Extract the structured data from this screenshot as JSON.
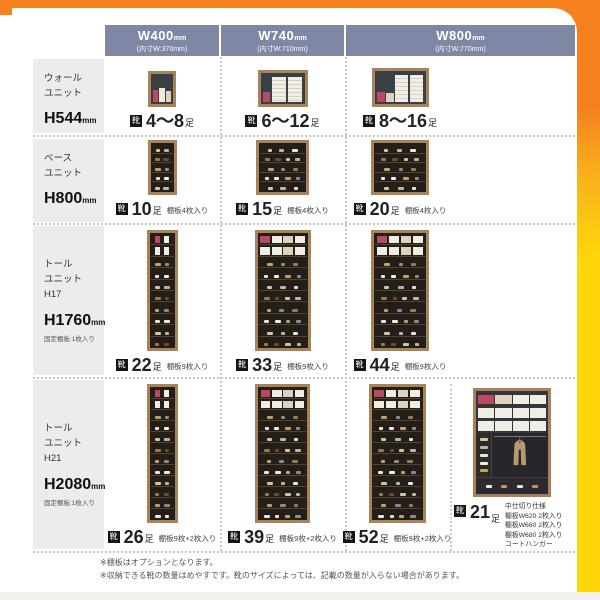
{
  "palette": {
    "orange": "#f5801e",
    "yellow": "#ffd60a",
    "header_bg": "#7e87a3",
    "label_bg": "#ececec",
    "badge_bg": "#151515",
    "pink": "#b94a64",
    "white_box": "#f0ede4",
    "cream_box": "#ddd3bc",
    "wood": "#a8835a",
    "shoes": [
      "#d8c49a",
      "#f0ece2",
      "#9a7a52",
      "#b9b4ac",
      "#c2a06a",
      "#6e4a2e",
      "#e6e6e6",
      "#8c8c8c"
    ],
    "coat": "#b59a74",
    "gold": "#c49a3e"
  },
  "badge_label": "靴",
  "header": {
    "columns": [
      {
        "width": "W400",
        "unit": "mm",
        "inner": "(内寸W:370mm)"
      },
      {
        "width": "W740",
        "unit": "mm",
        "inner": "(内寸W:710mm)"
      },
      {
        "width": "W800",
        "unit": "mm",
        "inner": "(内寸W:770mm)"
      }
    ]
  },
  "rows": [
    {
      "label": {
        "lines": [
          "ウォール",
          "ユニット"
        ],
        "height": "H544",
        "height_unit": "mm",
        "note": ""
      },
      "cells": [
        {
          "count": "4〜8",
          "suffix": "足",
          "note": "",
          "art": {
            "type": "wall",
            "w": 28,
            "h": 36,
            "items": [
              {
                "t": "box",
                "c": "#b94a64",
                "wf": 28,
                "hf": 46
              },
              {
                "t": "box",
                "c": "#efe9dc",
                "wf": 28,
                "hf": 52
              },
              {
                "t": "box",
                "c": "#ddd3bc",
                "wf": 28,
                "hf": 42
              }
            ]
          }
        },
        {
          "count": "6〜12",
          "suffix": "足",
          "note": "",
          "art": {
            "type": "wall",
            "w": 50,
            "h": 37,
            "items": [
              {
                "t": "box",
                "c": "#b94a64",
                "wf": 17,
                "hf": 38
              },
              {
                "t": "panel",
                "wf": 33,
                "hf": 94
              },
              {
                "t": "panel",
                "wf": 33,
                "hf": 94
              }
            ]
          }
        },
        {
          "count": "8〜16",
          "suffix": "足",
          "note": "",
          "art": {
            "type": "wall",
            "w": 57,
            "h": 39,
            "items": [
              {
                "t": "box",
                "c": "#b94a64",
                "wf": 15,
                "hf": 36
              },
              {
                "t": "box",
                "c": "#ddd3bc",
                "wf": 15,
                "hf": 31
              },
              {
                "t": "panel",
                "wf": 26,
                "hf": 94
              },
              {
                "t": "panel",
                "wf": 26,
                "hf": 94
              }
            ]
          }
        }
      ]
    },
    {
      "label": {
        "lines": [
          "ベース",
          "ユニット"
        ],
        "height": "H800",
        "height_unit": "mm",
        "note": ""
      },
      "cells": [
        {
          "count": "10",
          "suffix": "足",
          "note": "棚板4枚入り",
          "art": {
            "type": "shoes",
            "w": 29,
            "h": 56,
            "shelves": 5,
            "box_rows": 0
          }
        },
        {
          "count": "15",
          "suffix": "足",
          "note": "棚板4枚入り",
          "art": {
            "type": "shoes",
            "w": 53,
            "h": 57,
            "shelves": 5,
            "box_rows": 0
          }
        },
        {
          "count": "20",
          "suffix": "足",
          "note": "棚板4枚入り",
          "art": {
            "type": "shoes",
            "w": 58,
            "h": 58,
            "shelves": 5,
            "box_rows": 0
          }
        }
      ]
    },
    {
      "label": {
        "lines": [
          "トール",
          "ユニット",
          "H17"
        ],
        "height": "H1760",
        "height_unit": "mm",
        "note": "固定棚板:1枚入り"
      },
      "cells": [
        {
          "count": "22",
          "suffix": "足",
          "note": "棚板9枚入り",
          "art": {
            "type": "shoes",
            "w": 31,
            "h": 122,
            "shelves": 10,
            "box_rows": 2
          }
        },
        {
          "count": "33",
          "suffix": "足",
          "note": "棚板9枚入り",
          "art": {
            "type": "shoes",
            "w": 56,
            "h": 123,
            "shelves": 10,
            "box_rows": 2
          }
        },
        {
          "count": "44",
          "suffix": "足",
          "note": "棚板9枚入り",
          "art": {
            "type": "shoes",
            "w": 58,
            "h": 123,
            "shelves": 10,
            "box_rows": 2
          }
        }
      ]
    },
    {
      "label": {
        "lines": [
          "トール",
          "ユニット",
          "H21"
        ],
        "height": "H2080",
        "height_unit": "mm",
        "note": "固定棚板:1枚入り"
      },
      "cells": [
        {
          "count": "26",
          "suffix": "足",
          "note": "棚板9枚+2枚入り",
          "art": {
            "type": "shoes",
            "w": 31,
            "h": 140,
            "shelves": 12,
            "box_rows": 2
          }
        },
        {
          "count": "39",
          "suffix": "足",
          "note": "棚板9枚+2枚入り",
          "art": {
            "type": "shoes",
            "w": 55,
            "h": 141,
            "shelves": 12,
            "box_rows": 2
          }
        },
        {
          "count": "52",
          "suffix": "足",
          "note": "棚板9枚+2枚入り",
          "art": {
            "type": "shoes",
            "w": 57,
            "h": 141,
            "shelves": 12,
            "box_rows": 2
          }
        },
        {
          "count": "21",
          "suffix": "足",
          "note": "",
          "notes": [
            "中仕切り仕様",
            "棚板W620 2枚入り",
            "棚板W660 2枚入り",
            "棚板W680 2枚入り",
            "コートハンガー"
          ],
          "art": {
            "type": "locker",
            "w": 78,
            "h": 137
          }
        }
      ]
    }
  ],
  "footnotes": [
    "※棚板はオプションとなります。",
    "※収納できる靴の数量はめやすです。靴のサイズによっては、記載の数量が入らない場合があります。"
  ]
}
